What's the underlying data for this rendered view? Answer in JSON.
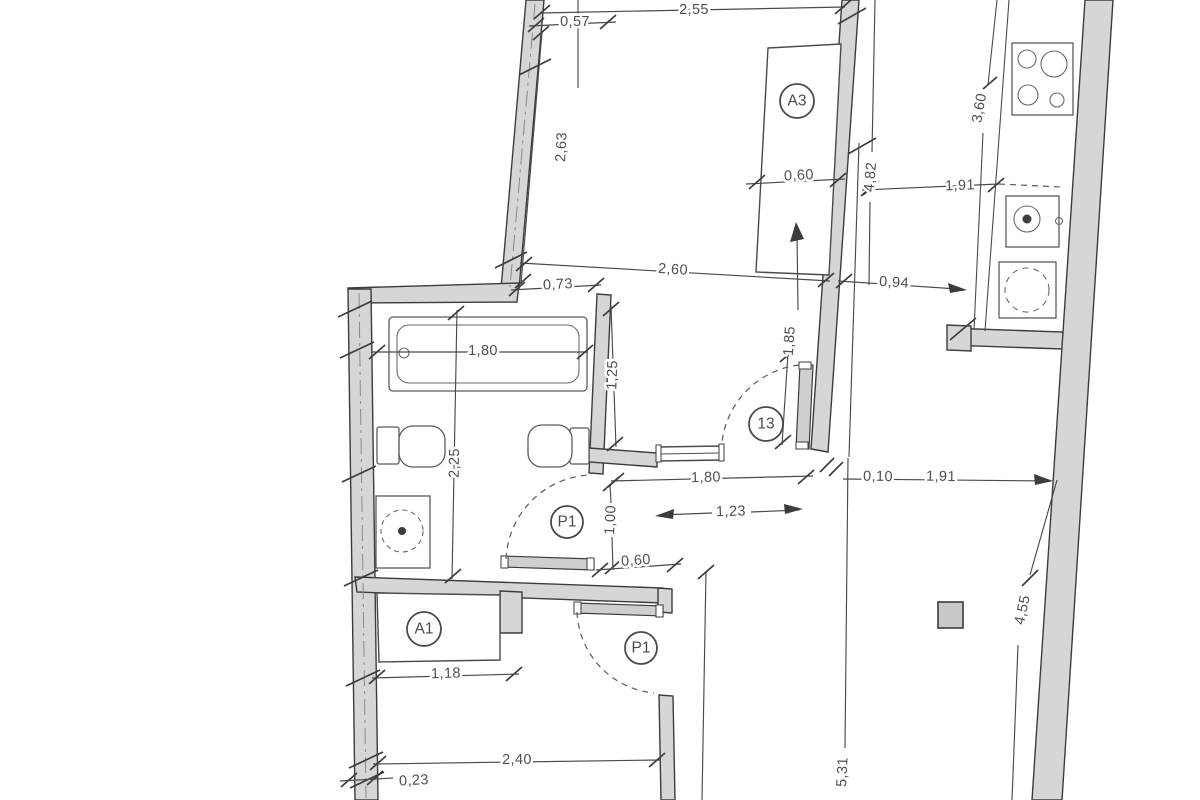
{
  "document": {
    "kind": "architectural-floor-plan",
    "background": "#ffffff"
  },
  "colors": {
    "wall_fill": "#d6d6d6",
    "wall_stroke": "#3c3c3c",
    "dim_line": "#4a4a4a",
    "dim_text": "#4f4f4f"
  },
  "room_labels": {
    "a3": "A3",
    "door_13": "13",
    "p1_bathroom": "P1",
    "a1": "A1",
    "p1_bedroom": "P1"
  },
  "dimensions": {
    "d255": "2,55",
    "d057": "0,57",
    "d263": "2,63",
    "d060_top": "0,60",
    "d482": "4,82",
    "d191_top": "1,91",
    "d360": "3,60",
    "d260": "2,60",
    "d073": "0,73",
    "d094": "0,94",
    "d180_tub": "1,80",
    "d225": "2,25",
    "d125": "1,25",
    "d185": "1,85",
    "d180_hall": "1,80",
    "d010": "0,10",
    "d191_right": "1,91",
    "d123": "1,23",
    "d100": "1,00",
    "d060_hall": "0,60",
    "d118": "1,18",
    "d240": "2,40",
    "d023": "0,23",
    "d455": "4,55",
    "d531": "5,31"
  },
  "fixtures": {
    "bathtub": "bathtub",
    "toilet": "toilet",
    "bidet": "bidet",
    "washbasin": "washbasin",
    "stove": "stove-4-burners",
    "kitchen_sink": "kitchen-sink",
    "washing_machine": "washing-machine",
    "radiator": "radiator-window-sill",
    "column": "column",
    "closet_a3": "closet-A3",
    "closet_a1": "closet-A1"
  }
}
